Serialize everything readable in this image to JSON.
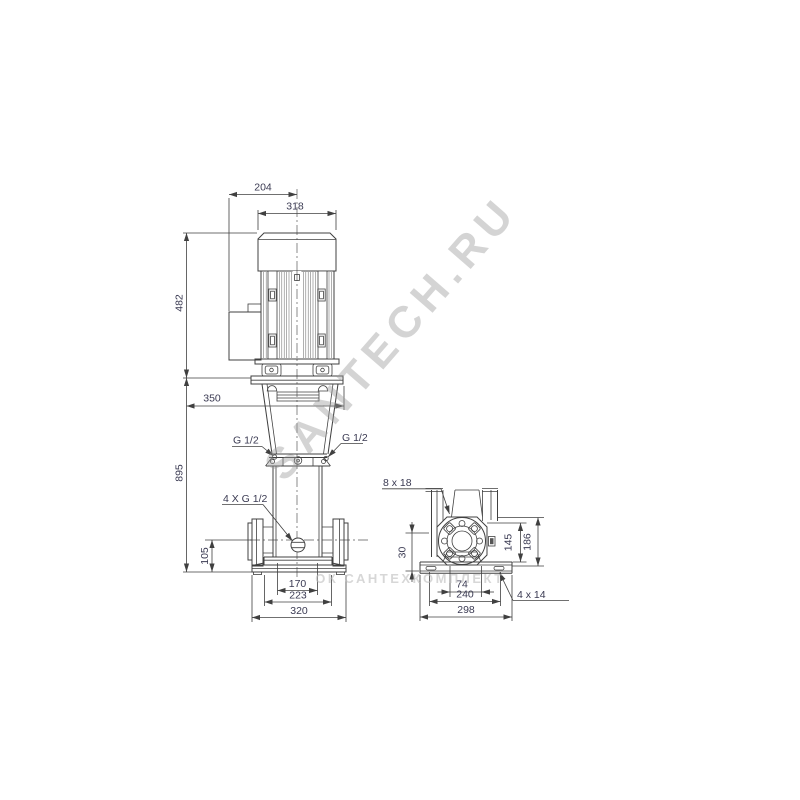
{
  "page": {
    "background": "#ffffff"
  },
  "colors": {
    "linework": "#404040",
    "dimension_text": "#3a3a52",
    "watermark_diagonal": "#9a9a9a",
    "watermark_horizontal": "#bdbdbd"
  },
  "front_view": {
    "dims": {
      "fan_cover_width": "204",
      "motor_width": "318",
      "motor_height": "482",
      "total_height": "895",
      "service_width": "350",
      "port_center_height": "105",
      "base_top_width": "170",
      "base_mid_width": "223",
      "port_to_port": "320"
    },
    "labels": {
      "plug_left": "G 1/2",
      "plug_right": "G 1/2",
      "gauge_ports": "4 X G 1/2"
    }
  },
  "side_view": {
    "dims": {
      "base_height": "30",
      "foot_width": "74",
      "bolt_spacing": "240",
      "base_length": "298",
      "flange_height_inner": "145",
      "flange_height_outer": "186"
    },
    "labels": {
      "flange_holes": "8 x 18",
      "base_holes": "4 x 14"
    }
  },
  "watermarks": {
    "diagonal": "SANTECH.RU",
    "horizontal": "ОК САНТЕХКОМПЛЕКТ"
  }
}
